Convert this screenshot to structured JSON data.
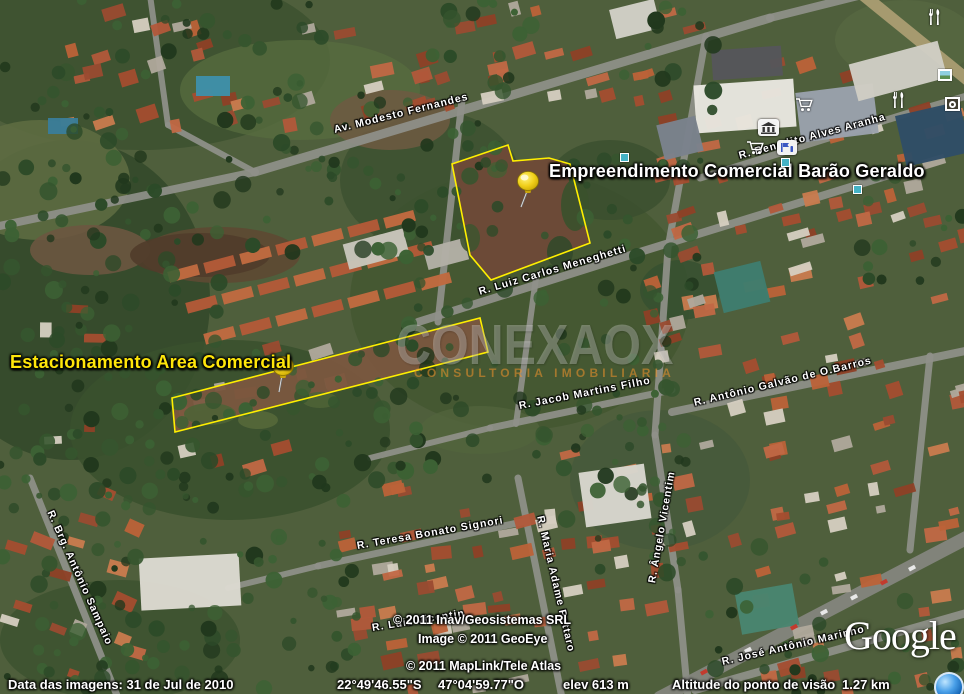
{
  "placemarks": {
    "empreendimento": {
      "label": "Empreendimento Comercial Barão Geraldo",
      "outline_points": "452,164 508,145 513,161 549,158 570,164 590,243 491,280 470,255"
    },
    "estacionamento": {
      "label": "Estacionamento Area Comercial",
      "outline_points": "172,398 480,318 488,352 175,432"
    }
  },
  "streets": [
    {
      "name": "Av. Modesto Fernandes"
    },
    {
      "name": "R. Luiz Carlos Meneghetti"
    },
    {
      "name": "R. Benedito Alves Aranha"
    },
    {
      "name": "R. Luiz Vicentin"
    },
    {
      "name": "R. Brg. Antônio Sampaio"
    },
    {
      "name": "R. Teresa Bonato Signori"
    },
    {
      "name": "R. Maria Adame Pattaro"
    },
    {
      "name": "R. Jacob Martins Filho"
    },
    {
      "name": "R. Ângelo Vicentim"
    },
    {
      "name": "R. Antônio Galvão de O.Barros"
    },
    {
      "name": "R. José Antônio Marinho"
    }
  ],
  "watermark": {
    "brand": "CONEXAOX",
    "tagline": "CONSULTORIA IMOBILIARIA"
  },
  "copyright_lines": {
    "imagery_provider": "© 2011 Inav/Geosistemas SRL",
    "image_credit": "Image © 2011 GeoEye",
    "map_data": "© 2011 MapLink/Tele Atlas"
  },
  "status_bar": {
    "imagery_date": "Data das imagens: 31 de Jul de 2010",
    "latitude": "22°49'46.55\"S",
    "longitude": "47°04'59.77\"O",
    "elevation": "elev 613 m",
    "eye_altitude_label": "Altitude do ponto de visão",
    "eye_altitude_value": "1.27 km"
  },
  "logo_text": "Google",
  "poi_icons": [
    "restaurant-icon",
    "restaurant-icon",
    "shopping-cart-icon",
    "shopping-cart-icon",
    "museum-icon",
    "info-icon",
    "photo-icon",
    "webcam-icon",
    "placemark-square-icon",
    "placemark-square-icon",
    "placemark-square-icon"
  ],
  "colors": {
    "annotation_yellow": "#ffef00",
    "pushpin_yellow": "#f0cf1a",
    "placemark_label_white": "#ffffff",
    "placemark_label_yellow": "#ffe60a",
    "watermark_gray": "rgba(238,238,238,0.30)",
    "watermark_orange": "rgba(242,148,44,0.55)"
  }
}
